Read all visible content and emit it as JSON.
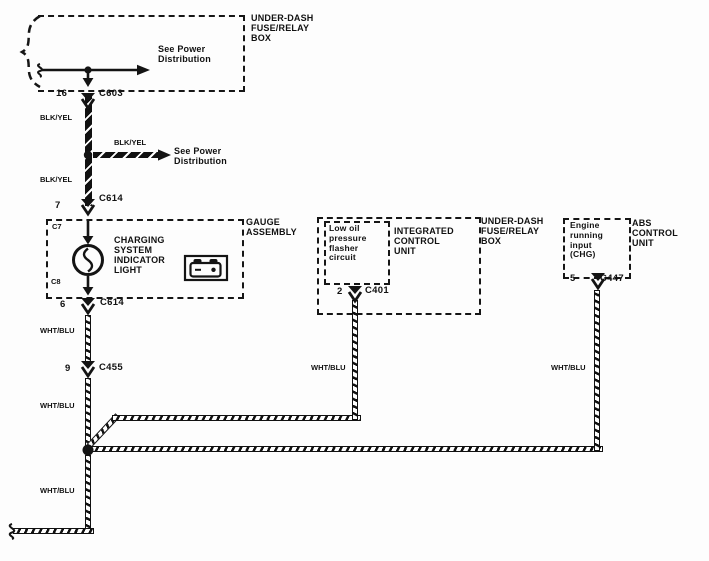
{
  "diagram_title": "Charging system wiring diagram",
  "boxes": {
    "fuse_box_top_label": "UNDER-DASH\nFUSE/RELAY\nBOX",
    "gauge_assembly_label": "GAUGE\nASSEMBLY",
    "icu_label": "INTEGRATED\nCONTROL\nUNIT",
    "fuse_box_mid_label": "UNDER-DASH\nFUSE/RELAY\nBOX",
    "abs_label": "ABS\nCONTROL\nUNIT"
  },
  "notes": {
    "see_power_top": "See Power\nDistribution",
    "see_power_mid": "See Power\nDistribution",
    "charging_light": "CHARGING\nSYSTEM\nINDICATOR\nLIGHT",
    "low_oil": "Low oil\npressure\nflasher\ncircuit",
    "engine_input": "Engine\nrunning\ninput\n(CHG)",
    "terminal_c7": "C7",
    "terminal_c8": "C8"
  },
  "connectors": {
    "c603": {
      "pin": "16",
      "name": "C603"
    },
    "c614_top": {
      "pin": "7",
      "name": "C614"
    },
    "c614_bottom": {
      "pin": "6",
      "name": "C614"
    },
    "c455": {
      "pin": "9",
      "name": "C455"
    },
    "c401": {
      "pin": "2",
      "name": "C401"
    },
    "c447": {
      "pin": "5",
      "name": "C447"
    }
  },
  "wire_labels": {
    "blk_yel_1": "BLK/YEL",
    "blk_yel_2": "BLK/YEL",
    "blk_yel_3": "BLK/YEL",
    "wht_blu_1": "WHT/BLU",
    "wht_blu_2": "WHT/BLU",
    "wht_blu_mid": "WHT/BLU",
    "wht_blu_right": "WHT/BLU",
    "wht_blu_bottom": "WHT/BLU"
  },
  "colors": {
    "ink": "#141414",
    "paper": "#fdfdfd"
  }
}
